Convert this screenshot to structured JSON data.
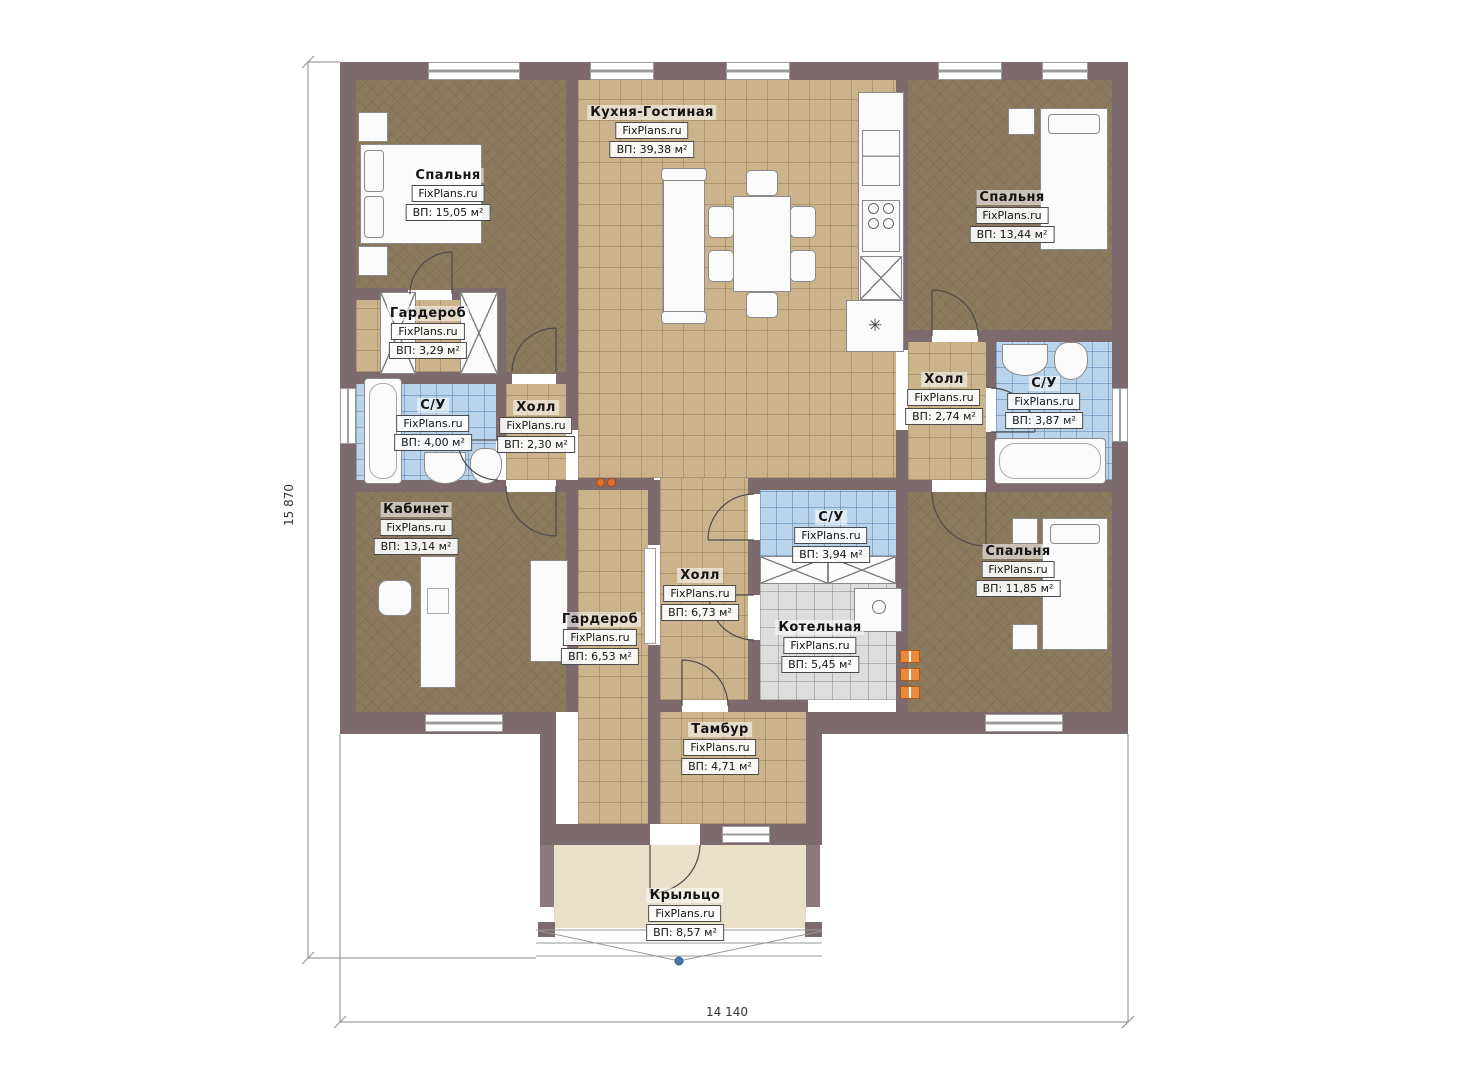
{
  "plan": {
    "brand": "FixPlans.ru",
    "dimensions": {
      "width": "14 140",
      "height": "15 870"
    },
    "rooms": [
      {
        "id": "kitchen-living",
        "name": "Кухня-Гостиная",
        "area": "ВП: 39,38 м²"
      },
      {
        "id": "bedroom-top-left",
        "name": "Спальня",
        "area": "ВП: 15,05 м²"
      },
      {
        "id": "bedroom-top-right",
        "name": "Спальня",
        "area": "ВП: 13,44 м²"
      },
      {
        "id": "wardrobe-top",
        "name": "Гардероб",
        "area": "ВП: 3,29 м²"
      },
      {
        "id": "bathroom-left",
        "name": "С/У",
        "area": "ВП: 4,00 м²"
      },
      {
        "id": "hall-left",
        "name": "Холл",
        "area": "ВП: 2,30 м²"
      },
      {
        "id": "hall-right",
        "name": "Холл",
        "area": "ВП: 2,74 м²"
      },
      {
        "id": "bathroom-right",
        "name": "С/У",
        "area": "ВП: 3,87 м²"
      },
      {
        "id": "office",
        "name": "Кабинет",
        "area": "ВП: 13,14 м²"
      },
      {
        "id": "bathroom-center",
        "name": "С/У",
        "area": "ВП: 3,94 м²"
      },
      {
        "id": "hall-center",
        "name": "Холл",
        "area": "ВП: 6,73 м²"
      },
      {
        "id": "wardrobe-bottom",
        "name": "Гардероб",
        "area": "ВП: 6,53 м²"
      },
      {
        "id": "boiler-room",
        "name": "Котельная",
        "area": "ВП: 5,45 м²"
      },
      {
        "id": "bedroom-bottom-right",
        "name": "Спальня",
        "area": "ВП: 11,85 м²"
      },
      {
        "id": "vestibule",
        "name": "Тамбур",
        "area": "ВП: 4,71 м²"
      },
      {
        "id": "porch",
        "name": "Крыльцо",
        "area": "ВП: 8,57 м²"
      }
    ]
  }
}
